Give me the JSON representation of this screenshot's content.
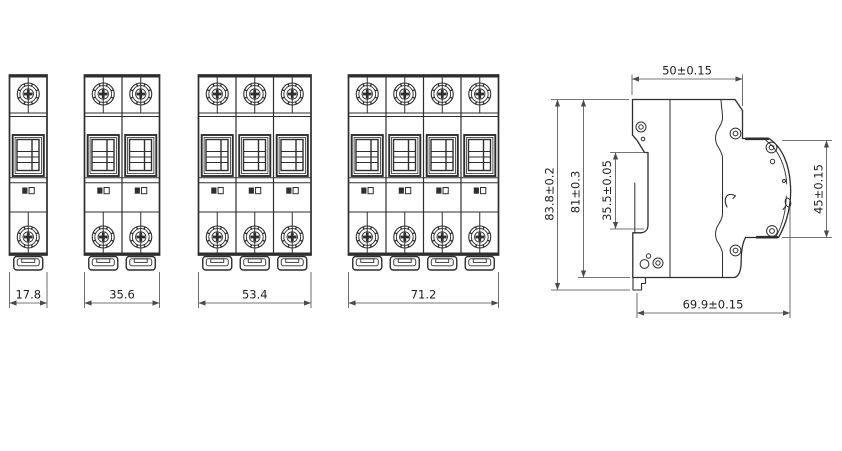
{
  "colors": {
    "background": "#ffffff",
    "line": "#2e2e2e",
    "dimension_line": "#4a4a4a",
    "text": "#1e1e1e"
  },
  "front_views": [
    {
      "poles": 1,
      "width_label": "17.8"
    },
    {
      "poles": 2,
      "width_label": "35.6"
    },
    {
      "poles": 3,
      "width_label": "53.4"
    },
    {
      "poles": 4,
      "width_label": "71.2"
    }
  ],
  "side_view": {
    "dimensions": {
      "top_width": "50±0.15",
      "overall_height": "83.8±0.2",
      "body_height": "81±0.3",
      "din_recess_height": "35.5±0.05",
      "front_face_height": "45±0.15",
      "depth": "69.9±0.15"
    }
  }
}
